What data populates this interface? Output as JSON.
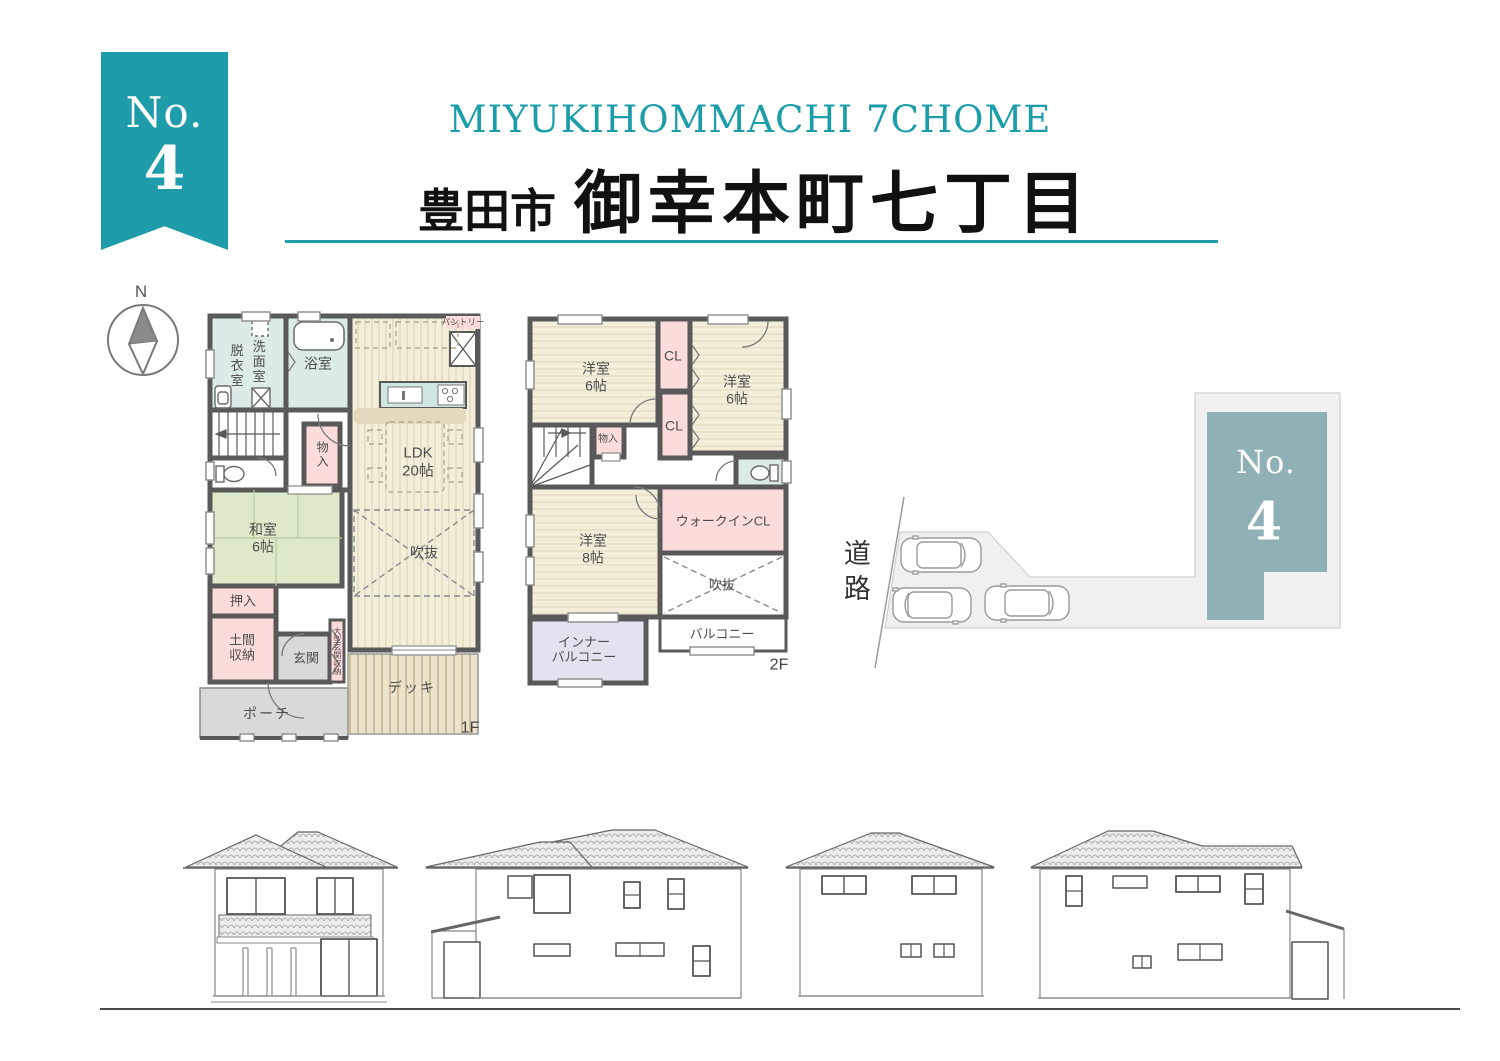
{
  "badge": {
    "no": "No.",
    "number": "4"
  },
  "header": {
    "en": "MIYUKIHOMMACHI 7CHOME",
    "city": "豊田市",
    "district": "御幸本町七丁目"
  },
  "compass": {
    "north": "N"
  },
  "floor1": {
    "label": "1F",
    "rooms": {
      "datsui": "脱衣室",
      "senmen": "洗面室",
      "bath": "浴室",
      "pantry": "パントリー",
      "ldk": "LDK\n20帖",
      "storage": "物入",
      "washitsu": "和室\n6帖",
      "void": "吹抜",
      "oshiire": "押入",
      "doma": "土間\n収納",
      "genkan": "玄関",
      "ogata": "大型玄関収納",
      "deck": "デッキ",
      "porch": "ポーチ"
    }
  },
  "floor2": {
    "label": "2F",
    "rooms": {
      "bed6l": "洋室\n6帖",
      "cl_top": "CL",
      "bed6r": "洋室\n6帖",
      "cl_mid": "CL",
      "storage": "物入",
      "bed8": "洋室\n8帖",
      "walkin_cl": "ウォークインCL",
      "void": "吹抜",
      "balcony": "バルコニー",
      "inner_balcony": "インナー\nバルコニー"
    }
  },
  "site": {
    "road": "道路",
    "building_no": "No.",
    "building_number": "4"
  },
  "colors": {
    "accent_teal": "#1b9daa",
    "building_fill": "#8fb1b6",
    "room_pink": "#fbdcdb",
    "room_blue": "#dcebe7",
    "room_green": "#dde9c9",
    "room_cream": "#f2eeda",
    "room_lavender": "#e4e2ee",
    "room_gray": "#d9d9da",
    "deck_tan": "#ece3cb",
    "wall": "#595959"
  }
}
